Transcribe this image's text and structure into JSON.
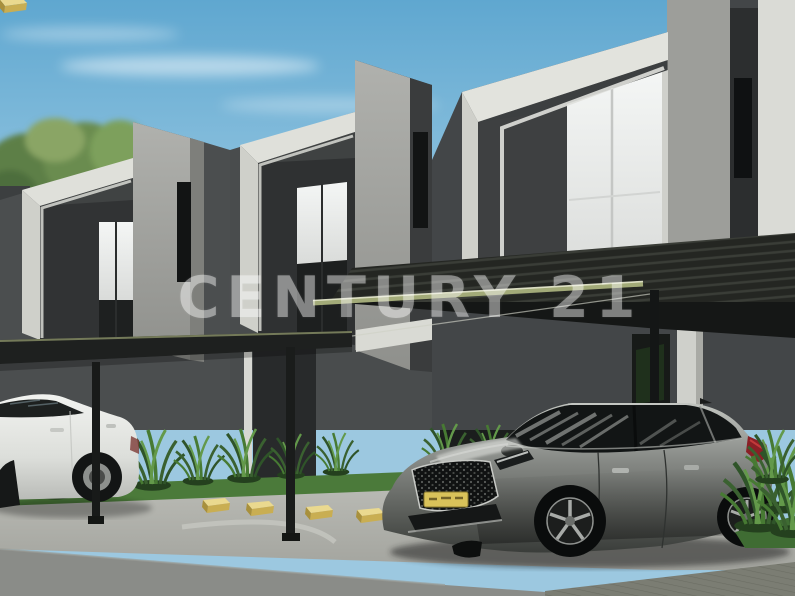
{
  "meta": {
    "kind": "architectural-render-photo",
    "description": "3D real-estate rendering of a row of modern two-story townhouses with dark flat carport canopies, a gray hatchback parked in front, a white sedan at left, spiky shrubs and yellow wheel stops along the parking apron",
    "width": 795,
    "height": 596
  },
  "watermark": {
    "text": "CENTURY 21",
    "color": "#ffffff",
    "opacity": 0.45
  },
  "scene": {
    "sky": {
      "top": "#5fa7d0",
      "bottom": "#c6e3f0",
      "clouds": "wispy white streaks"
    },
    "trees": {
      "label": "foliage behind left perimeter wall",
      "green": "#6a8c50"
    },
    "buildings": {
      "count": 3,
      "label": "two-story modern townhouse units",
      "wall_white": "#dfe0da",
      "wall_gray": "#a0a19d",
      "wall_dark": "#4b4e4f",
      "recess_dark": "#303233",
      "curtain": "#eff1f0",
      "slit_window": "#121414"
    },
    "carport": {
      "label": "flat dark carport canopies",
      "surface": "#222421",
      "edge": "#a2aa78",
      "edge_highlight": "#e8ead0",
      "posts": 3
    },
    "vehicles": [
      {
        "label": "white sedan, partially visible at left",
        "color": "#ecedea"
      },
      {
        "label": "gray hatchback parked under canopy",
        "color": "#7d807c",
        "plate_color": "#d9c25a",
        "taillight": "#8a2026"
      }
    ],
    "landscape": {
      "grass": "#4b7a3a",
      "plants": "spiky green lily-turf clusters",
      "plant_green": "#477a33"
    },
    "parking": {
      "wheel_stops": 6,
      "wheel_stop_color": "#ead98f",
      "concrete": "#b5b6b0",
      "asphalt": "#8a8c88",
      "pavers": "#66685f"
    }
  }
}
